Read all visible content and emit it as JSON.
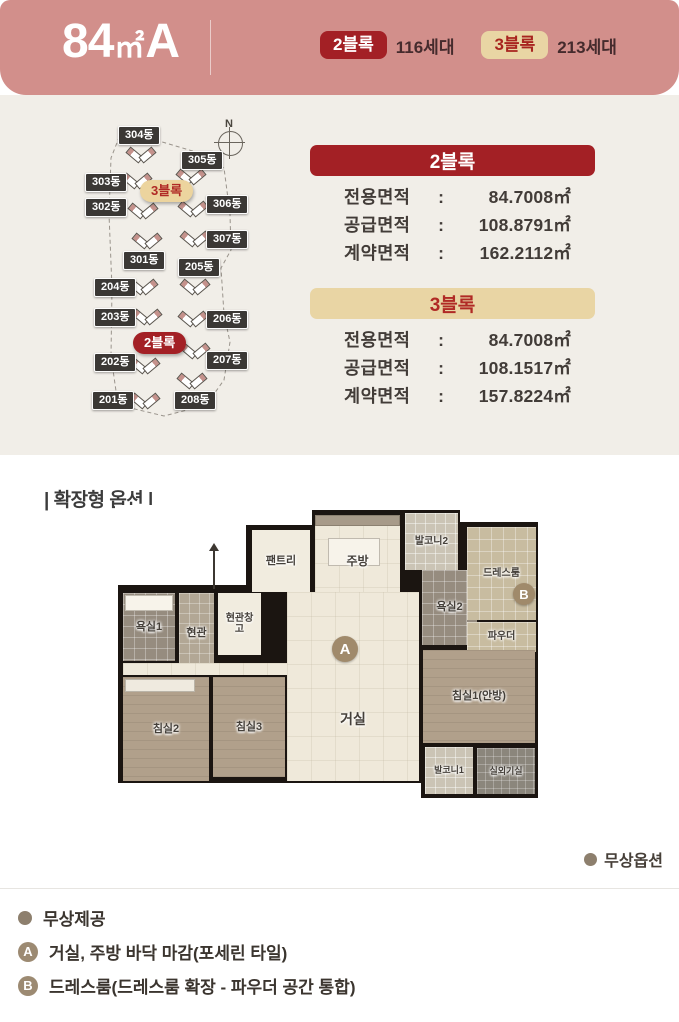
{
  "header": {
    "title_num": "84",
    "title_unit": "㎡",
    "title_type": "A",
    "blocks": [
      {
        "label": "2블록",
        "units": "116세대",
        "style": "red"
      },
      {
        "label": "3블록",
        "units": "213세대",
        "style": "tan"
      }
    ]
  },
  "site_map": {
    "compass_label": "N",
    "buildings": [
      {
        "name": "304동",
        "lx": 40,
        "ly": 8,
        "ix": 48,
        "iy": 28
      },
      {
        "name": "305동",
        "lx": 103,
        "ly": 33,
        "ix": 98,
        "iy": 50
      },
      {
        "name": "303동",
        "lx": 7,
        "ly": 55,
        "ix": 44,
        "iy": 54
      },
      {
        "name": "302동",
        "lx": 7,
        "ly": 80,
        "ix": 50,
        "iy": 84
      },
      {
        "name": "306동",
        "lx": 128,
        "ly": 77,
        "ix": 100,
        "iy": 82
      },
      {
        "name": "307동",
        "lx": 128,
        "ly": 112,
        "ix": 102,
        "iy": 112
      },
      {
        "name": "301동",
        "lx": 45,
        "ly": 133,
        "ix": 54,
        "iy": 114
      },
      {
        "name": "205동",
        "lx": 100,
        "ly": 140,
        "ix": 102,
        "iy": 160
      },
      {
        "name": "204동",
        "lx": 16,
        "ly": 160,
        "ix": 50,
        "iy": 160
      },
      {
        "name": "203동",
        "lx": 16,
        "ly": 190,
        "ix": 54,
        "iy": 190
      },
      {
        "name": "206동",
        "lx": 128,
        "ly": 192,
        "ix": 100,
        "iy": 192
      },
      {
        "name": "207동",
        "lx": 128,
        "ly": 233,
        "ix": 102,
        "iy": 224
      },
      {
        "name": "202동",
        "lx": 16,
        "ly": 235,
        "ix": 52,
        "iy": 239
      },
      {
        "name": "201동",
        "lx": 14,
        "ly": 273,
        "ix": 52,
        "iy": 274
      },
      {
        "name": "208동",
        "lx": 96,
        "ly": 273,
        "ix": 99,
        "iy": 254
      }
    ],
    "block_ovals": [
      {
        "text": "3블록",
        "style": "tan",
        "x": 62,
        "y": 62
      },
      {
        "text": "2블록",
        "style": "red",
        "x": 55,
        "y": 214
      }
    ]
  },
  "info_cards": [
    {
      "title": "2블록",
      "style": "red",
      "rows": [
        {
          "label": "전용면적",
          "value": "84.7008㎡"
        },
        {
          "label": "공급면적",
          "value": "108.8791㎡"
        },
        {
          "label": "계약면적",
          "value": "162.2112㎡"
        }
      ]
    },
    {
      "title": "3블록",
      "style": "tan",
      "rows": [
        {
          "label": "전용면적",
          "value": "84.7008㎡"
        },
        {
          "label": "공급면적",
          "value": "108.1517㎡"
        },
        {
          "label": "계약면적",
          "value": "157.8224㎡"
        }
      ]
    }
  ],
  "floor_plan": {
    "section_label": "| 확장형 옵션 |",
    "rooms": [
      {
        "id": "bath1",
        "label": "욕실1",
        "x": 8,
        "y": 88,
        "w": 52,
        "h": 68,
        "cls": "tile-gray"
      },
      {
        "id": "entry",
        "label": "현관",
        "x": 64,
        "y": 88,
        "w": 35,
        "h": 80,
        "cls": "entry-floor"
      },
      {
        "id": "entry-storage",
        "label": "현관창고",
        "x": 103,
        "y": 88,
        "w": 43,
        "h": 62,
        "cls": "white-floor",
        "fs": 10,
        "wrap": true
      },
      {
        "id": "pantry",
        "label": "팬트리",
        "x": 137,
        "y": 25,
        "w": 58,
        "h": 62,
        "cls": "white-floor"
      },
      {
        "id": "kitchen",
        "label": "주방",
        "x": 200,
        "y": 10,
        "w": 85,
        "h": 77,
        "cls": "cream-floor",
        "ly": 52,
        "fs": 12
      },
      {
        "id": "balcony2",
        "label": "발코니2",
        "x": 290,
        "y": 8,
        "w": 53,
        "h": 57,
        "cls": "tile-light",
        "fs": 10
      },
      {
        "id": "bath2",
        "label": "욕실2",
        "x": 307,
        "y": 65,
        "w": 55,
        "h": 75,
        "cls": "tile-gray"
      },
      {
        "id": "dress",
        "label": "드레스룸",
        "x": 352,
        "y": 22,
        "w": 69,
        "h": 93,
        "cls": "tan-floor",
        "fs": 10
      },
      {
        "id": "powder",
        "label": "파우더",
        "x": 352,
        "y": 117,
        "w": 69,
        "h": 30,
        "cls": "tan-floor",
        "fs": 10
      },
      {
        "id": "hall",
        "label": "",
        "x": 8,
        "y": 158,
        "w": 170,
        "h": 12,
        "cls": "cream-floor"
      },
      {
        "id": "living",
        "label": "거실",
        "x": 172,
        "y": 87,
        "w": 132,
        "h": 189,
        "cls": "cream-floor",
        "ly": 63,
        "fs": 14
      },
      {
        "id": "bedroom2",
        "label": "침실2",
        "x": 8,
        "y": 172,
        "w": 86,
        "h": 104,
        "cls": "wood"
      },
      {
        "id": "bedroom3",
        "label": "침실3",
        "x": 98,
        "y": 172,
        "w": 72,
        "h": 100,
        "cls": "wood"
      },
      {
        "id": "bedroom1",
        "label": "침실1(안방)",
        "x": 308,
        "y": 145,
        "w": 112,
        "h": 93,
        "cls": "wood"
      },
      {
        "id": "balcony1",
        "label": "발코니1",
        "x": 310,
        "y": 242,
        "w": 48,
        "h": 47,
        "cls": "tile-light",
        "fs": 9
      },
      {
        "id": "acroom",
        "label": "실외기실",
        "x": 362,
        "y": 243,
        "w": 58,
        "h": 46,
        "cls": "tile-dark",
        "fs": 9
      }
    ],
    "fixtures": [
      {
        "x": 200,
        "y": 10,
        "w": 85,
        "h": 11,
        "c": "#a79a89"
      },
      {
        "x": 213,
        "y": 33,
        "w": 52,
        "h": 28,
        "c": "#f7f3ea"
      },
      {
        "x": 10,
        "y": 90,
        "w": 48,
        "h": 16,
        "c": "#f7f3ea"
      },
      {
        "x": 10,
        "y": 174,
        "w": 70,
        "h": 13,
        "c": "#efeadf"
      }
    ],
    "badges": [
      {
        "letter": "A",
        "x": 217,
        "y": 131,
        "d": 26
      },
      {
        "letter": "B",
        "x": 398,
        "y": 78,
        "d": 22
      }
    ]
  },
  "footer": {
    "option_note": "무상옵션",
    "legend": [
      {
        "marker": "dot",
        "text": "무상제공"
      },
      {
        "marker": "A",
        "text": "거실, 주방 바닥 마감(포세린 타일)"
      },
      {
        "marker": "B",
        "text": "드레스룸(드레스룸 확장 - 파우더 공간 통합)"
      }
    ]
  },
  "colors": {
    "header_pink": "#d28f8b",
    "block_red": "#a32025",
    "block_tan": "#e9d5a4",
    "cream_bg": "#f1eee8",
    "badge_brown": "#a08a6b"
  }
}
